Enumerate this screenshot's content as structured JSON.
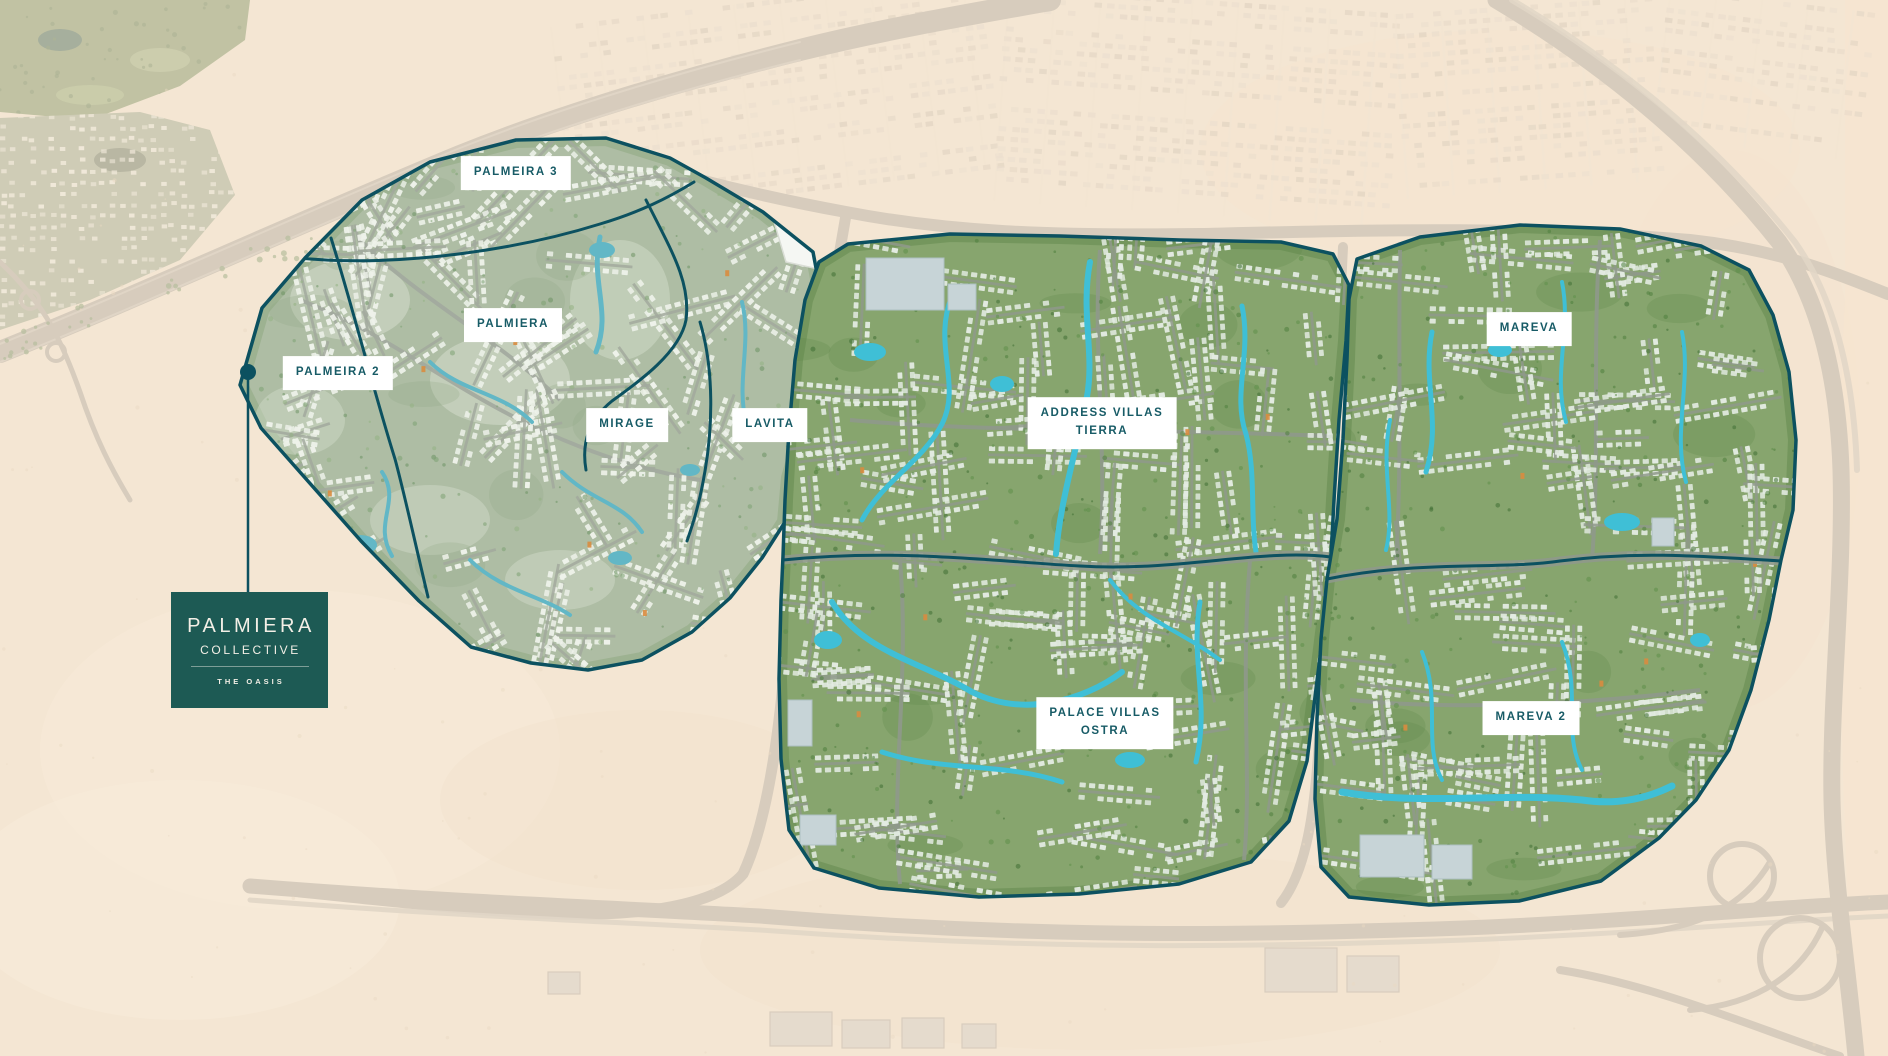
{
  "logo": {
    "brand": "PALMIERA",
    "collection": "COLLECTIVE",
    "tagline": "THE OASIS"
  },
  "communities": [
    {
      "id": "palmeira-3",
      "label": "PALMEIRA 3"
    },
    {
      "id": "palmiera",
      "label": "PALMIERA"
    },
    {
      "id": "palmeira-2",
      "label": "PALMEIRA 2"
    },
    {
      "id": "mirage",
      "label": "MIRAGE"
    },
    {
      "id": "lavita",
      "label": "LAVITA"
    },
    {
      "id": "address-villas-tierra",
      "label": "ADDRESS VILLAS\nTIERRA"
    },
    {
      "id": "mareva",
      "label": "MAREVA"
    },
    {
      "id": "palace-villas-ostra",
      "label": "PALACE VILLAS\nOSTRA"
    },
    {
      "id": "mareva-2",
      "label": "MAREVA 2"
    }
  ],
  "colors": {
    "boundary": "#0c5160",
    "label_bg": "#ffffff",
    "label_text": "#175b66",
    "logo_bg": "#1d5a54",
    "logo_text": "#f3efe6",
    "sand": "#f1e2cf",
    "wash": "#f7e9d6",
    "water_vivid": "#3fbfd6",
    "water_muted": "#62b7c6",
    "cluster_green": "#87a56e",
    "cluster_green_muted": "#aebda4",
    "road_faded": "#b4aca1",
    "road_light": "#c9c1b5"
  }
}
